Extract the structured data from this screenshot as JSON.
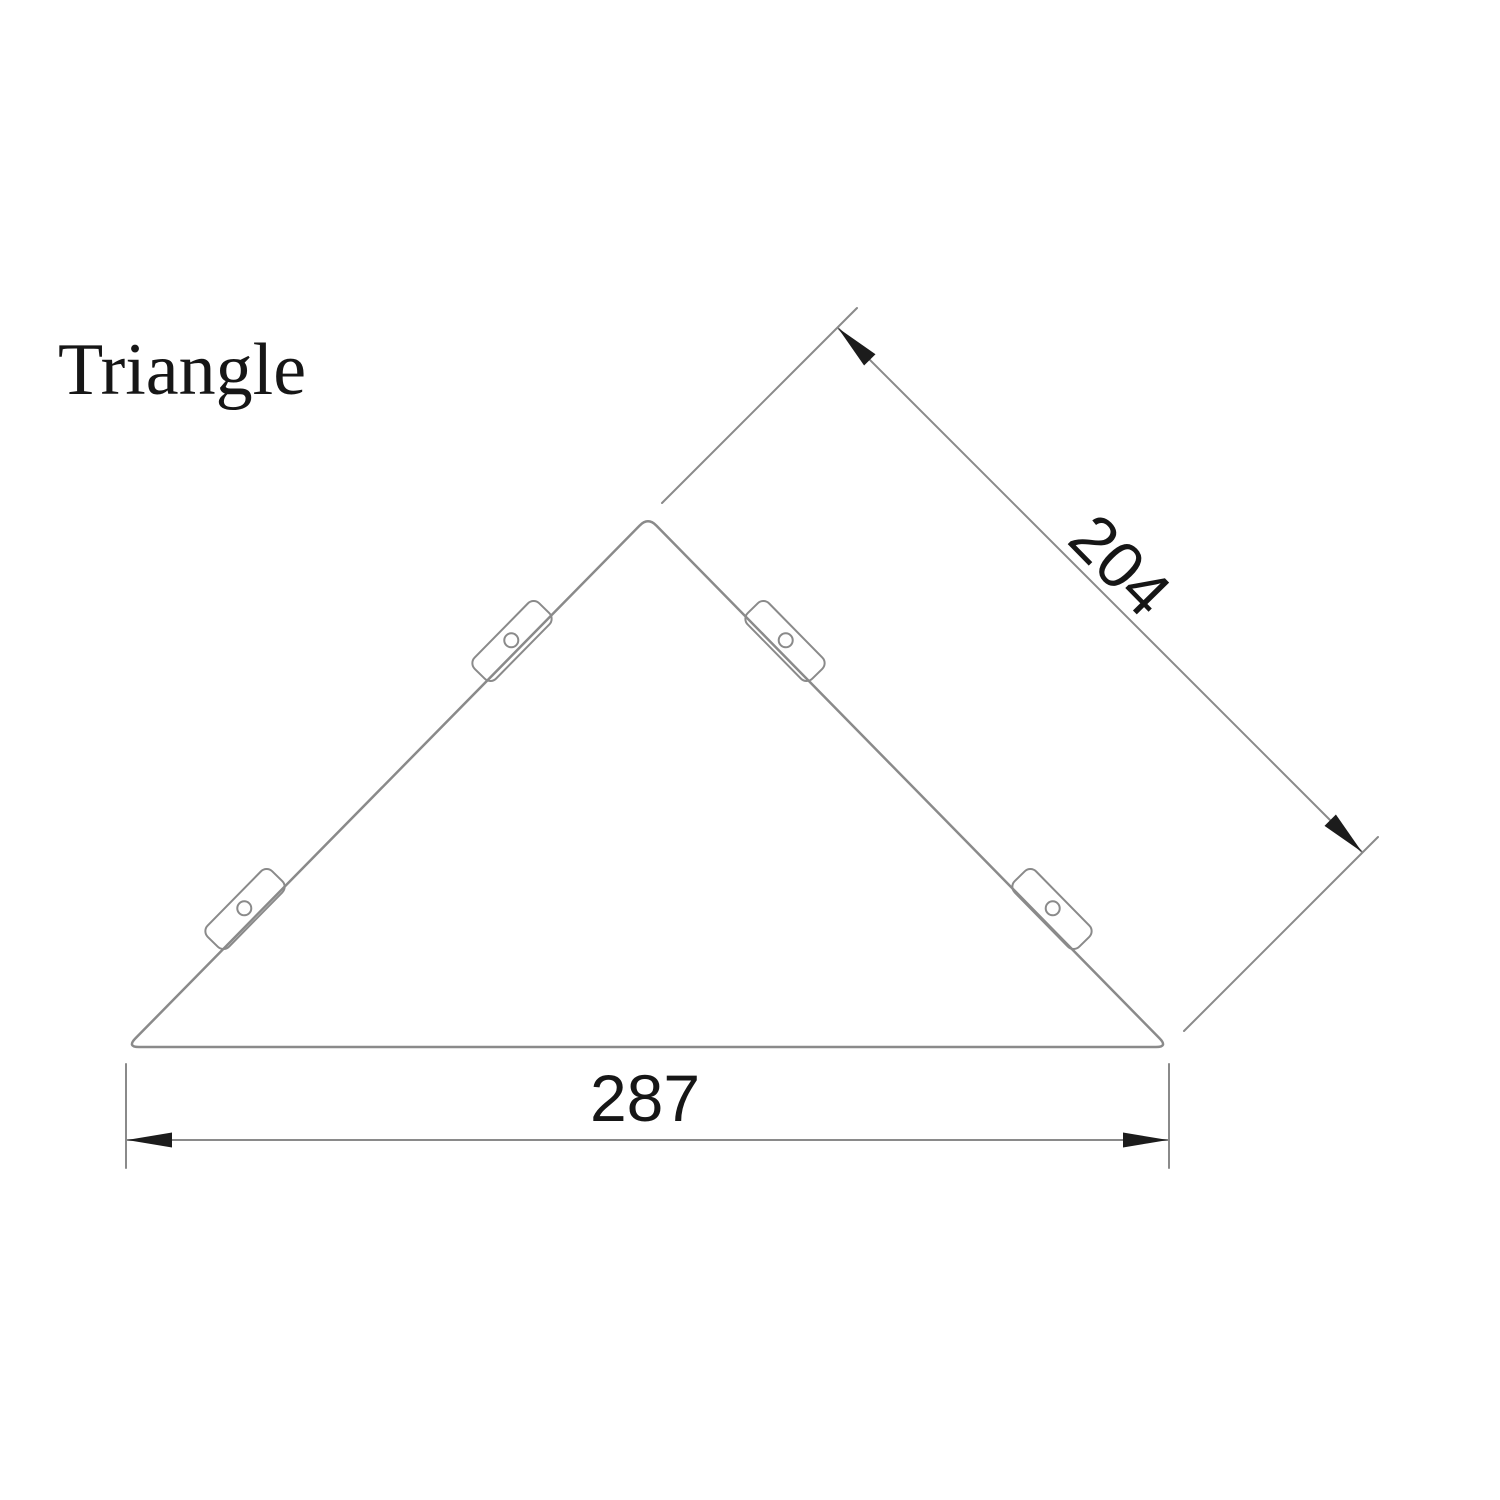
{
  "title": "Triangle",
  "drawing": {
    "dimensions": {
      "side": "204",
      "base": "287"
    },
    "mounting_tabs_count": 4
  },
  "colors": {
    "line": "#8a8a8a",
    "arrow": "#1c1c1c",
    "text": "#161616",
    "background": "#ffffff"
  }
}
